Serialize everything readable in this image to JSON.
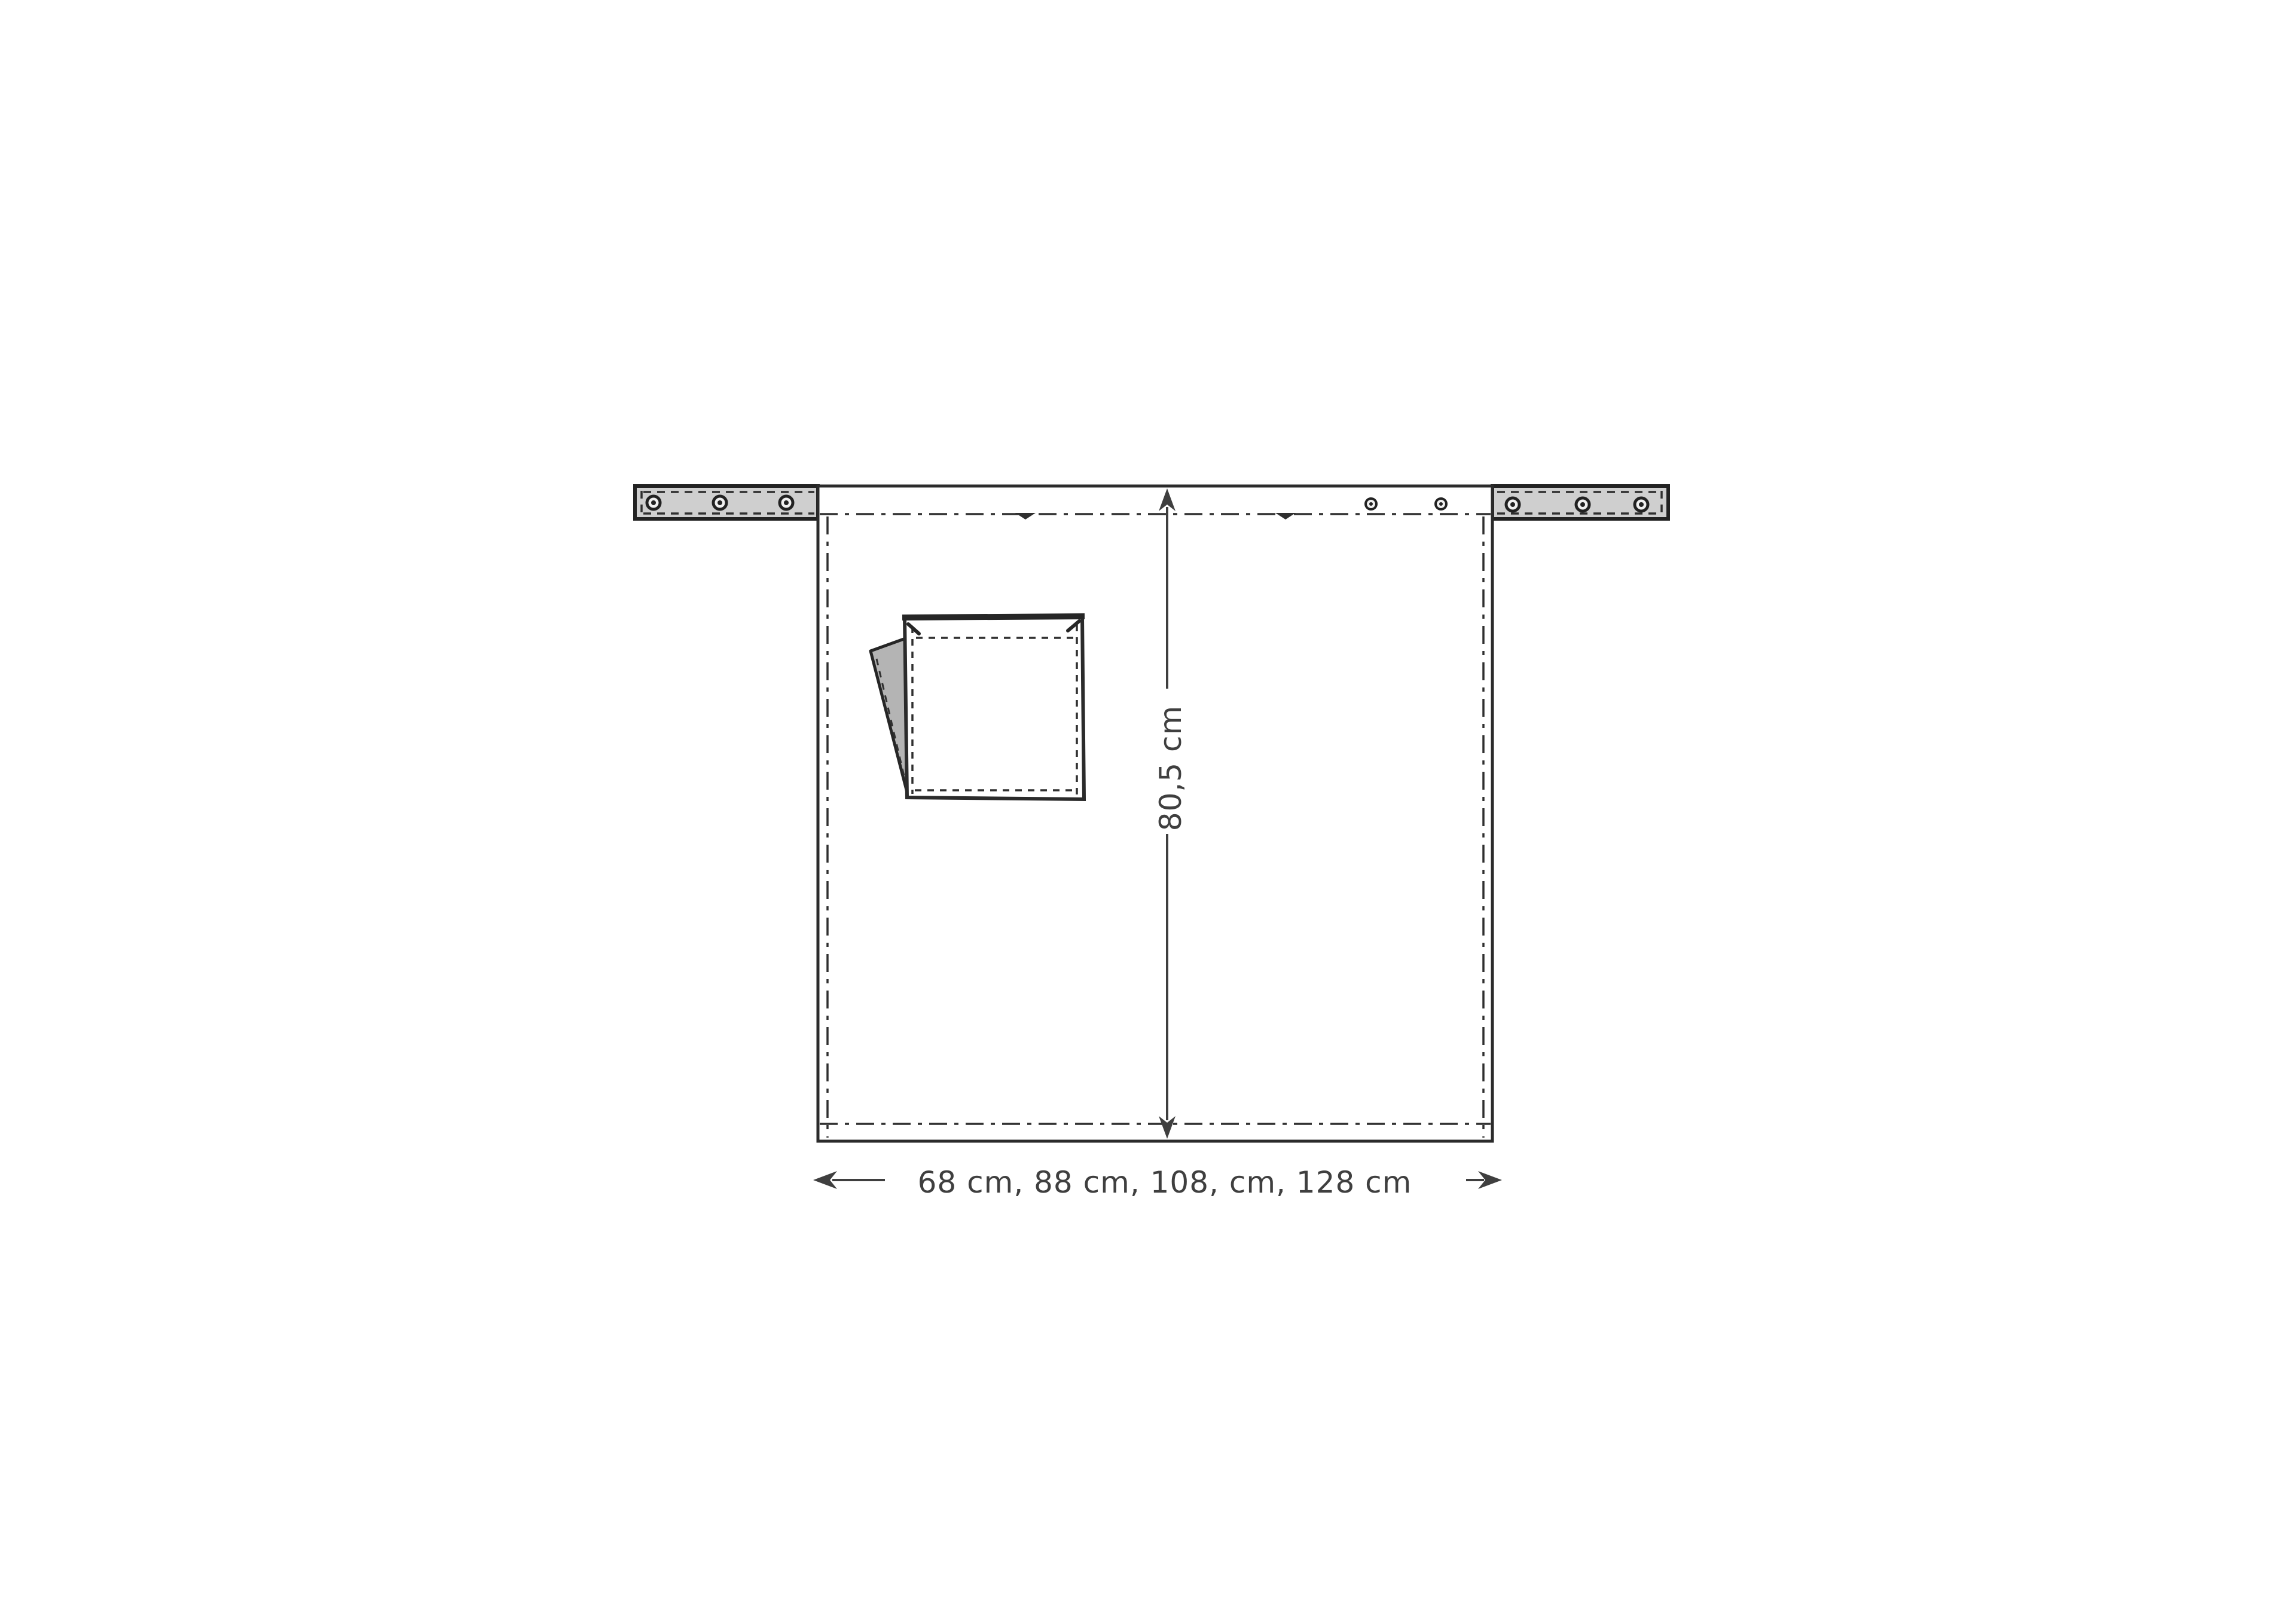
{
  "figure": {
    "kind": "apron-sewing-pattern-diagram",
    "background": "#ffffff",
    "colors": {
      "line": "#2b2b2b",
      "dimension": "#3f3f3f",
      "text": "#3f3f3f",
      "tie_fill": "#cfcfcf",
      "flap_fill": "#b4b4b4"
    },
    "dimensions": {
      "height_label": "80,5 cm",
      "width_label": "68 cm, 88 cm, 108, cm, 128 cm"
    }
  }
}
